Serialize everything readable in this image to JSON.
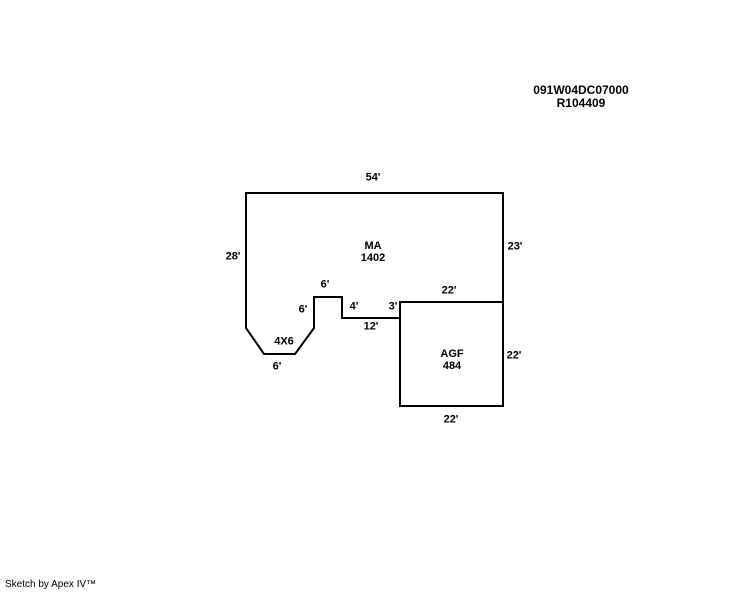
{
  "header": {
    "parcel_id": "091W04DC07000",
    "record_id": "R104409"
  },
  "footer": {
    "credit": "Sketch by Apex IV™"
  },
  "sketch": {
    "ma": {
      "code": "MA",
      "area": "1402",
      "dims": {
        "top": "54'",
        "left": "28'",
        "right": "23'",
        "shared_top": "22'",
        "step": "3'",
        "bottom_run": "12'",
        "notch_right": "4'",
        "notch_top": "6'",
        "notch_left": "6'",
        "bay": "4X6",
        "bay_bottom": "6'"
      }
    },
    "agf": {
      "code": "AGF",
      "area": "484",
      "dims": {
        "right": "22'",
        "bottom": "22'"
      }
    }
  },
  "colors": {
    "line": "#000000",
    "text": "#000000",
    "background": "#ffffff"
  }
}
